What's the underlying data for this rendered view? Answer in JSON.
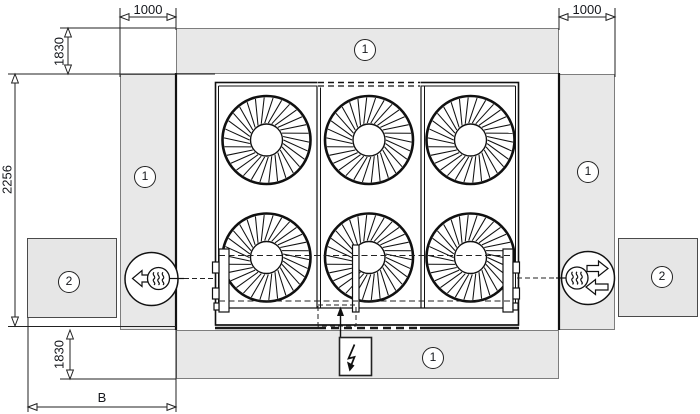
{
  "drawing": {
    "title": "unit-installation-clearance-top-view",
    "dimensions": {
      "top_left_clearance": "1000",
      "top_right_clearance": "1000",
      "upper_side_clearance": "1830",
      "unit_depth": "2256",
      "lower_side_clearance": "1830",
      "bottom_width": "B"
    },
    "markers": {
      "clearance_zone": "1",
      "obstacle": "2"
    },
    "icons": {
      "left_connection": "heat-exchanger-outlet-arrow-left",
      "right_connection": "heat-exchanger-inlet-outlet-arrows",
      "power": "lightning-bolt",
      "fans": "axial-fan-impeller"
    },
    "colors": {
      "zone_fill": "#e8e8e8",
      "zone_border": "#7d7d7d",
      "line": "#111111",
      "text": "#15171c"
    }
  }
}
